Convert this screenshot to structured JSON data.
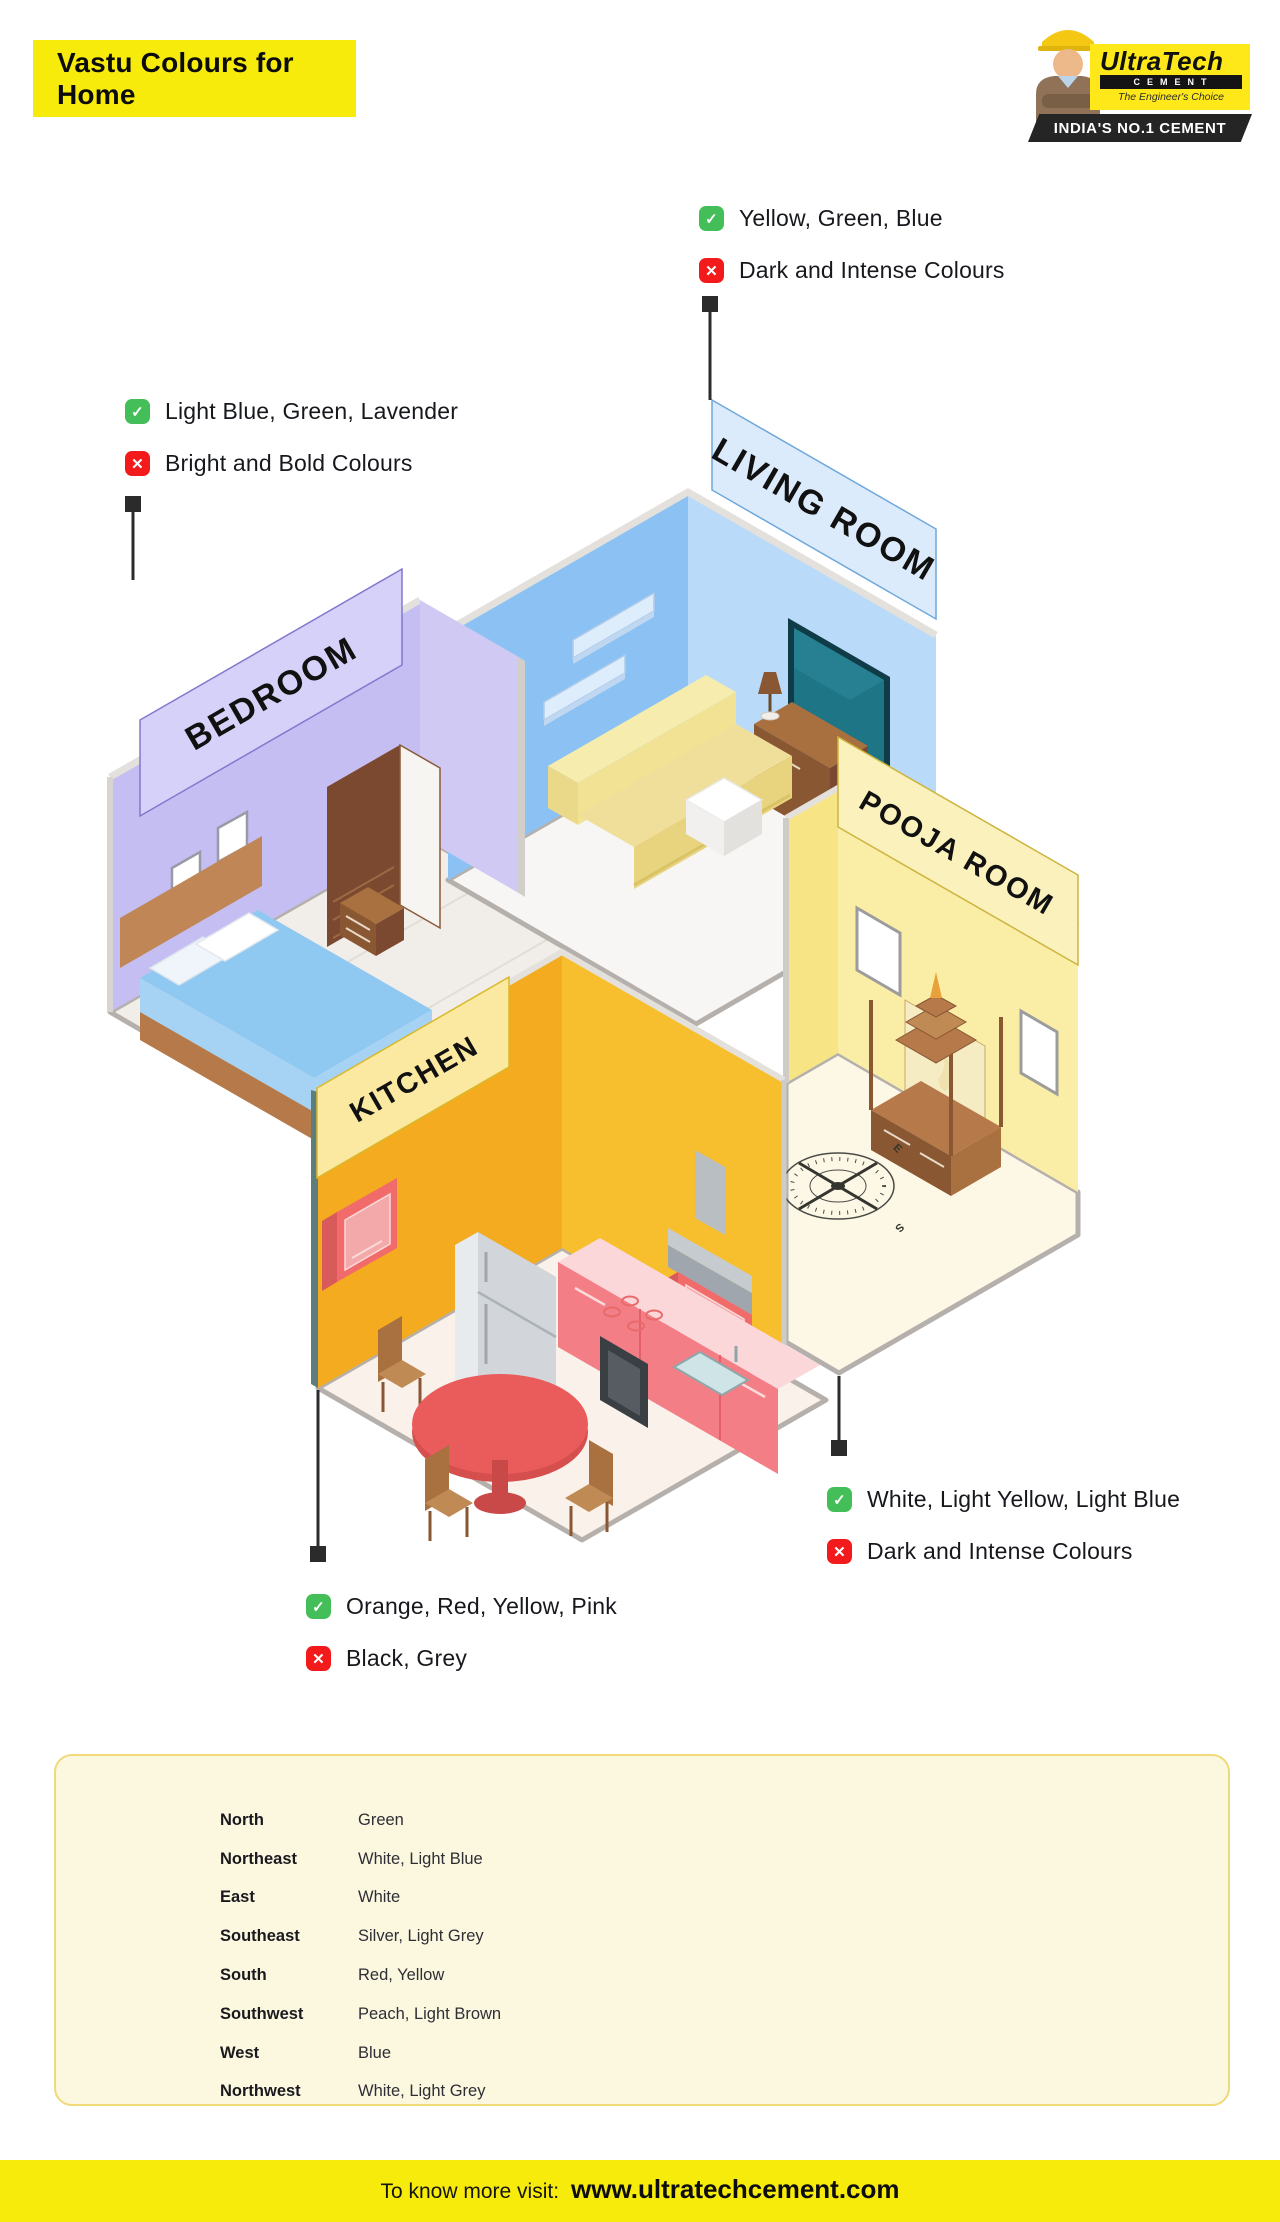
{
  "header": {
    "title": "Vastu Colours for Home"
  },
  "logo": {
    "brand": "UltraTech",
    "word": "CEMENT",
    "tagline": "The Engineer's Choice",
    "banner": "INDIA'S NO.1 CEMENT"
  },
  "icons": {
    "check": "✓",
    "cross": "✕"
  },
  "rooms": [
    {
      "id": "living",
      "label": "LIVING ROOM",
      "allowed": "Yellow, Green, Blue",
      "avoid": "Dark and Intense Colours"
    },
    {
      "id": "bedroom",
      "label": "BEDROOM",
      "allowed": "Light Blue, Green, Lavender",
      "avoid": "Bright and Bold Colours"
    },
    {
      "id": "pooja",
      "label": "POOJA ROOM",
      "allowed": "White, Light Yellow, Light Blue",
      "avoid": "Dark and Intense Colours"
    },
    {
      "id": "kitchen",
      "label": "KITCHEN",
      "allowed": "Orange, Red, Yellow, Pink",
      "avoid": "Black, Grey"
    }
  ],
  "vastu_table": {
    "rows": [
      {
        "direction": "North",
        "colours": "Green"
      },
      {
        "direction": "Northeast",
        "colours": "White, Light Blue"
      },
      {
        "direction": "East",
        "colours": "White"
      },
      {
        "direction": "Southeast",
        "colours": "Silver, Light Grey"
      },
      {
        "direction": "South",
        "colours": "Red, Yellow"
      },
      {
        "direction": "Southwest",
        "colours": "Peach, Light Brown"
      },
      {
        "direction": "West",
        "colours": "Blue"
      },
      {
        "direction": "Northwest",
        "colours": "White, Light Grey"
      }
    ]
  },
  "compass": {
    "n": "N",
    "e": "E",
    "s": "S",
    "w": "W"
  },
  "footer": {
    "prefix": "To know more visit:",
    "url": "www.ultratechcement.com"
  },
  "colors": {
    "accent_yellow": "#F7EB0B",
    "check_green": "#44BE58",
    "cross_red": "#F21A1A",
    "living_wall": "#8CC2F3",
    "bedroom_wall": "#C5BEF3",
    "pooja_wall": "#F9E98E",
    "kitchen_wall": "#F4AB1F",
    "panel_bg": "#FCF8E0",
    "panel_border": "#EFD978"
  }
}
